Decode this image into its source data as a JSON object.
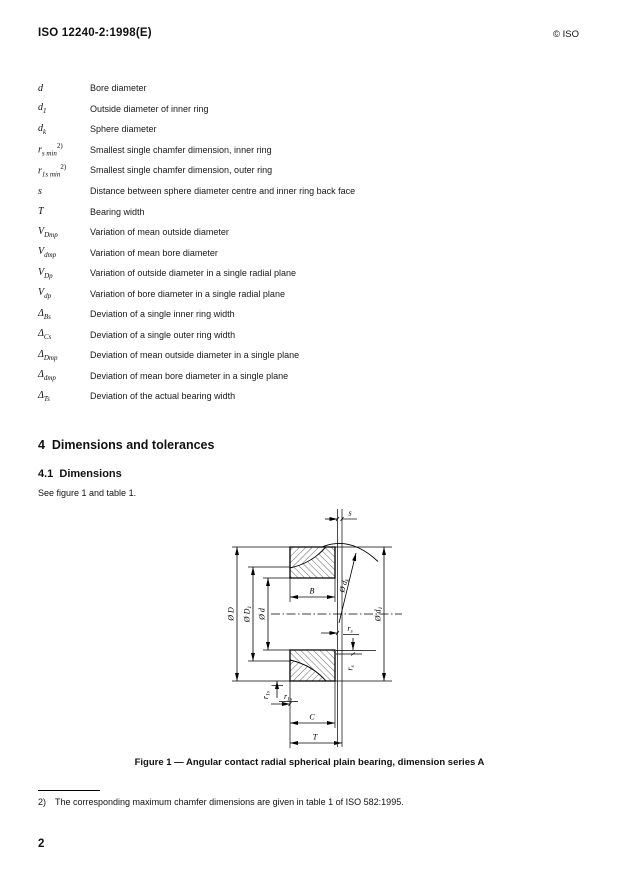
{
  "header": {
    "doc_number": "ISO 12240-2:1998(E)",
    "copyright": "© ISO"
  },
  "symbols": [
    {
      "base": "d",
      "sub": "",
      "sup": "",
      "definition": "Bore diameter"
    },
    {
      "base": "d",
      "sub": "1",
      "sup": "",
      "definition": "Outside diameter of inner ring"
    },
    {
      "base": "d",
      "sub": "k",
      "sup": "",
      "definition": "Sphere diameter"
    },
    {
      "base": "r",
      "sub": "s min",
      "sup": "2)",
      "definition": "Smallest single chamfer dimension, inner ring"
    },
    {
      "base": "r",
      "sub": "1s min",
      "sup": "2)",
      "definition": "Smallest single chamfer dimension, outer ring"
    },
    {
      "base": "s",
      "sub": "",
      "sup": "",
      "definition": "Distance between sphere diameter centre and inner ring back face"
    },
    {
      "base": "T",
      "sub": "",
      "sup": "",
      "definition": "Bearing width"
    },
    {
      "base": "V",
      "sub": "Dmp",
      "sup": "",
      "definition": "Variation of mean outside diameter"
    },
    {
      "base": "V",
      "sub": "dmp",
      "sup": "",
      "definition": "Variation of mean bore diameter"
    },
    {
      "base": "V",
      "sub": "Dp",
      "sup": "",
      "definition": "Variation of outside diameter in a single radial plane"
    },
    {
      "base": "V",
      "sub": "dp",
      "sup": "",
      "definition": "Variation of bore diameter in a single radial plane"
    },
    {
      "base": "Δ",
      "sub": "Bs",
      "sup": "",
      "definition": "Deviation of a single inner ring width"
    },
    {
      "base": "Δ",
      "sub": "Cs",
      "sup": "",
      "definition": "Deviation of a single outer ring width"
    },
    {
      "base": "Δ",
      "sub": "Dmp",
      "sup": "",
      "definition": "Deviation of mean outside diameter in a single plane"
    },
    {
      "base": "Δ",
      "sub": "dmp",
      "sup": "",
      "definition": "Deviation of mean bore diameter in a single plane"
    },
    {
      "base": "Δ",
      "sub": "Ts",
      "sup": "",
      "definition": "Deviation of the actual bearing width"
    }
  ],
  "section": {
    "heading": "4  Dimensions and tolerances",
    "subheading": "4.1  Dimensions",
    "body": "See figure 1 and table 1."
  },
  "figure": {
    "caption": "Figure 1 — Angular contact radial spherical plain bearing, dimension series A",
    "labels": {
      "s": "s",
      "B": "B",
      "C": "C",
      "T": "T",
      "D": {
        "base": "Ø D",
        "sub": ""
      },
      "D1": {
        "base": "Ø D",
        "sub": "1"
      },
      "d": {
        "base": "Ø d",
        "sub": ""
      },
      "d1": {
        "base": "Ø d",
        "sub": "1"
      },
      "dk": {
        "base": "Ø d",
        "sub": "k"
      },
      "rs": {
        "base": "r",
        "sub": "s"
      },
      "r1s": {
        "base": "r",
        "sub": "1s"
      }
    }
  },
  "footnote": {
    "marker": "2)",
    "text": "The corresponding maximum chamfer dimensions are given in table 1 of ISO 582:1995."
  },
  "page_number": "2"
}
